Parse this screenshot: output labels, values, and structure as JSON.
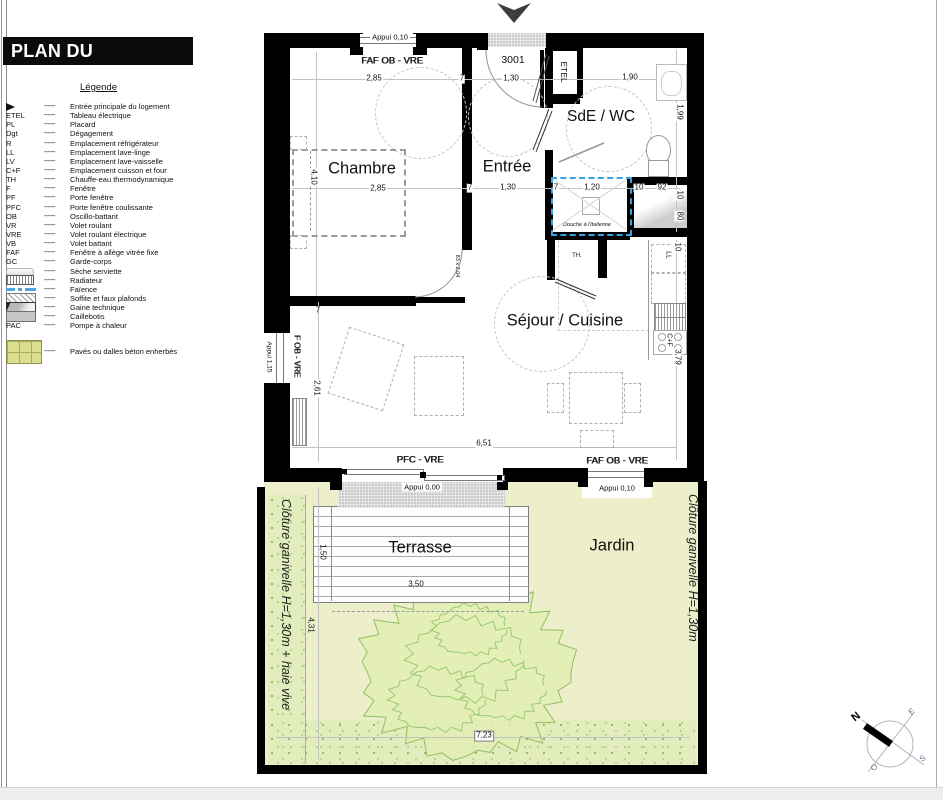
{
  "title": "PLAN DU LOGEMENT",
  "legend": {
    "heading": "Légende",
    "dash": "------",
    "items": [
      {
        "symbol": "entrance-arrow",
        "label": "Entrée principale du logement"
      },
      {
        "code": "ETEL",
        "label": "Tableau électrique"
      },
      {
        "code": "PL",
        "label": "Placard"
      },
      {
        "code": "Dgt",
        "label": "Dégagement"
      },
      {
        "code": "R",
        "label": "Emplacement réfrigérateur"
      },
      {
        "code": "LL",
        "label": "Emplacement lave-linge"
      },
      {
        "code": "LV",
        "label": "Emplacement lave-vaisselle"
      },
      {
        "code": "C+F",
        "label": "Emplacement cuisson et four"
      },
      {
        "code": "TH",
        "label": "Chauffe-eau thermodynamique"
      },
      {
        "code": "F",
        "label": "Fenêtre"
      },
      {
        "code": "PF",
        "label": "Porte fenêtre"
      },
      {
        "code": "PFC",
        "label": "Porte fenêtre coulissante"
      },
      {
        "code": "OB",
        "label": "Oscillo-battant"
      },
      {
        "code": "VR",
        "label": "Volet roulant"
      },
      {
        "code": "VRE",
        "label": "Volet roulant électrique"
      },
      {
        "code": "VB",
        "label": "Volet battant"
      },
      {
        "code": "FAF",
        "label": "Fenêtre à allège vitrée fixe"
      },
      {
        "code": "GC",
        "label": "Garde-corps"
      },
      {
        "symbol": "seche-serviette",
        "label": "Sèche serviette"
      },
      {
        "symbol": "radiateur",
        "label": "Radiateur"
      },
      {
        "symbol": "faience",
        "label": "Faïence"
      },
      {
        "symbol": "soffite",
        "label": "Soffite et faux plafonds"
      },
      {
        "symbol": "gaine",
        "label": "Gaine technique"
      },
      {
        "symbol": "caillebotis",
        "label": "Caillebotis"
      },
      {
        "code": "PAC",
        "label": "Pompe à chaleur"
      },
      {
        "symbol": "paves",
        "label": "Pavés ou dalles béton enherbés",
        "spaced": true
      }
    ]
  },
  "rooms": {
    "chambre": "Chambre",
    "entree": "Entrée",
    "sde": "SdE / WC",
    "sejour": "Séjour / Cuisine",
    "terrasse": "Terrasse",
    "jardin": "Jardin",
    "th": "TH.",
    "etel": "ETEL",
    "douche": "Douche à l'italienne",
    "cuisson": "C+F",
    "lave_linge": "LL",
    "unit_number": "3001"
  },
  "dims": {
    "d0": "2,85",
    "d1": "7",
    "d2": "1,30",
    "d3": "1,90",
    "d4": "2,85",
    "d5": "7",
    "d6": "1,30",
    "d7": "7",
    "d8": "1,20",
    "d9": "10",
    "d10": "92",
    "d11": "10",
    "d12": "80",
    "d13": "4,10",
    "d14": "1,99",
    "d15": "2,61",
    "d16": "10",
    "d17": "3,79",
    "d18": "83 x 2,04",
    "d19": "6,51",
    "d20": "1,50",
    "d21": "3,50",
    "d22": "4,31",
    "d23": "7,23",
    "d24": "7"
  },
  "openings": {
    "faf_top": "FAF OB - VRE",
    "appui_top": "Appui 0,10",
    "pfc": "PFC - VRE",
    "faf_bottom": "FAF OB - VRE",
    "appui_terrasse": "Appui 0,00",
    "appui_jardin": "Appui 0,10",
    "f_left": "F OB - VRE",
    "appui_left": "Appui 1,15"
  },
  "garden": {
    "cloture_left": "Clôture ganivelle H=1,30m + haie vive",
    "cloture_right": "Clôture ganivelle H=1,30m"
  },
  "compass": {
    "n": "N",
    "e": "E",
    "s": "S",
    "o": "O"
  },
  "colors": {
    "wall": "#000000",
    "garden": "#edefcb",
    "hedge": "#a6cd7d",
    "tree": "#e2efb4",
    "shower_blue": "#35a2e2",
    "threshold_gray": "#cbcbcb"
  }
}
